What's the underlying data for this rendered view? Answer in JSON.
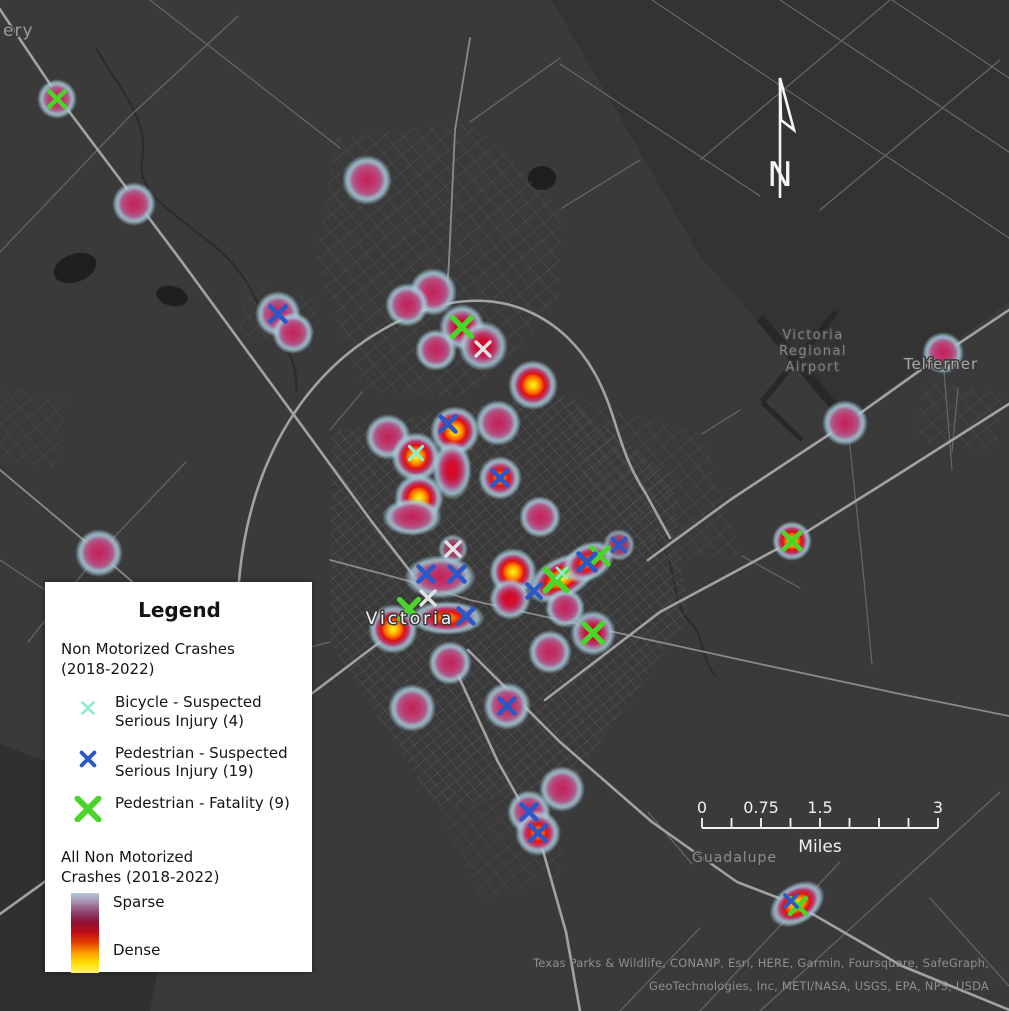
{
  "map": {
    "background_color": "#3a3a3a",
    "road_color": "#a2a2a2",
    "north_arrow_label": "N",
    "place_labels": [
      {
        "text": "ery",
        "x": 3,
        "y": 36,
        "size": 17,
        "color": "#9c9c9c",
        "anchor": "start",
        "spacing": 1
      },
      {
        "text": "Victoria",
        "x": 410,
        "y": 624,
        "size": 17,
        "color": "#f4f4f4",
        "anchor": "middle",
        "spacing": 3
      },
      {
        "text": "Victoria",
        "x": 813,
        "y": 339,
        "size": 13,
        "color": "#858585",
        "anchor": "middle",
        "spacing": 1.5
      },
      {
        "text": "Regional",
        "x": 813,
        "y": 355,
        "size": 13,
        "color": "#858585",
        "anchor": "middle",
        "spacing": 1.5
      },
      {
        "text": "Airport",
        "x": 813,
        "y": 371,
        "size": 13,
        "color": "#858585",
        "anchor": "middle",
        "spacing": 1.5
      },
      {
        "text": "Telferner",
        "x": 941,
        "y": 369,
        "size": 15,
        "color": "#a8a8a8",
        "anchor": "middle",
        "spacing": 1
      },
      {
        "text": "Guadalupe",
        "x": 692,
        "y": 862,
        "size": 14,
        "color": "#8d8d8d",
        "anchor": "start",
        "spacing": 1
      }
    ],
    "attribution_lines": [
      "Texas Parks & Wildlife, CONANP, Esri, HERE, Garmin, Foursquare, SafeGraph,",
      "GeoTechnologies, Inc, METI/NASA, USGS, EPA, NPS, USDA"
    ]
  },
  "scalebar": {
    "x": 702,
    "y": 828,
    "width": 236,
    "total_miles": 3,
    "divisions": 8,
    "unit": "Miles",
    "color": "#f2f2f2",
    "labels": [
      {
        "text": "0",
        "mile": 0
      },
      {
        "text": "0.75",
        "mile": 0.75
      },
      {
        "text": "1.5",
        "mile": 1.5
      },
      {
        "text": "3",
        "mile": 3
      }
    ]
  },
  "legend": {
    "title": "Legend",
    "section1_title": "Non Motorized Crashes\n(2018-2022)",
    "items": [
      {
        "type": "bicycle",
        "label": "Bicycle - Suspected Serious Injury (4)"
      },
      {
        "type": "pedestrian",
        "label": "Pedestrian - Suspected Serious Injury (19)"
      },
      {
        "type": "fatality",
        "label": "Pedestrian - Fatality (9)"
      }
    ],
    "section2_title": "All Non Motorized\nCrashes (2018-2022)",
    "sparse_label": "Sparse",
    "dense_label": "Dense",
    "gradient_colors": [
      "#b2cbd7",
      "#a487a9",
      "#8e3f6b",
      "#8f1030",
      "#c20d18",
      "#e34300",
      "#ff9e00",
      "#ffdf00",
      "#fff06e"
    ]
  },
  "marker_styles": {
    "bicycle": {
      "color": "#8feccf",
      "size": 6.5,
      "width": 3.2
    },
    "pedestrian": {
      "color": "#2b58c8",
      "size": 7.5,
      "width": 4.6
    },
    "fatality": {
      "color": "#4bd42a",
      "size": 10.5,
      "width": 6
    },
    "unknown": {
      "color": "#e3e3e3",
      "size": 7,
      "width": 3.4
    }
  },
  "heat_styles": {
    "pink": [
      [
        0,
        "#c2215a",
        1
      ],
      [
        0.38,
        "#bd3a6f",
        1
      ],
      [
        0.58,
        "#b05d8e",
        0.96
      ],
      [
        0.72,
        "#a9b4c8",
        0.9
      ],
      [
        0.8,
        "#a9cede",
        0.8
      ],
      [
        1,
        "#a9cede",
        0
      ]
    ],
    "red": [
      [
        0,
        "#e00520",
        1
      ],
      [
        0.3,
        "#cc1032",
        1
      ],
      [
        0.52,
        "#bb3f74",
        0.97
      ],
      [
        0.7,
        "#a9a0bd",
        0.9
      ],
      [
        0.79,
        "#a9cede",
        0.8
      ],
      [
        1,
        "#a9cede",
        0
      ]
    ],
    "orange": [
      [
        0,
        "#ffa400",
        1
      ],
      [
        0.2,
        "#ff6400",
        1
      ],
      [
        0.38,
        "#de1414",
        1
      ],
      [
        0.56,
        "#ba3e73",
        0.97
      ],
      [
        0.72,
        "#a9b4c8",
        0.9
      ],
      [
        0.81,
        "#a9cede",
        0.78
      ],
      [
        1,
        "#a9cede",
        0
      ]
    ],
    "yellow": [
      [
        0,
        "#fff133",
        1
      ],
      [
        0.16,
        "#ffc400",
        1
      ],
      [
        0.32,
        "#ff7000",
        1
      ],
      [
        0.47,
        "#dd1111",
        1
      ],
      [
        0.62,
        "#b93a70",
        0.97
      ],
      [
        0.75,
        "#a9b4c8",
        0.9
      ],
      [
        0.83,
        "#a9cede",
        0.75
      ],
      [
        1,
        "#a9cede",
        0
      ]
    ]
  },
  "heat_blobs": [
    {
      "x": 57,
      "y": 99,
      "r": 20,
      "kind": "pink"
    },
    {
      "x": 134,
      "y": 204,
      "r": 22,
      "kind": "pink"
    },
    {
      "x": 367,
      "y": 180,
      "r": 25,
      "kind": "pink"
    },
    {
      "x": 278,
      "y": 314,
      "r": 23,
      "kind": "pink"
    },
    {
      "x": 293,
      "y": 333,
      "r": 21,
      "kind": "pink"
    },
    {
      "x": 433,
      "y": 292,
      "r": 24,
      "kind": "pink"
    },
    {
      "x": 407,
      "y": 305,
      "r": 22,
      "kind": "pink"
    },
    {
      "x": 462,
      "y": 327,
      "r": 23,
      "kind": "red"
    },
    {
      "x": 483,
      "y": 346,
      "r": 25,
      "kind": "red"
    },
    {
      "x": 436,
      "y": 350,
      "r": 21,
      "kind": "pink"
    },
    {
      "x": 533,
      "y": 385,
      "r": 25,
      "kind": "yellow"
    },
    {
      "x": 388,
      "y": 437,
      "r": 23,
      "kind": "pink"
    },
    {
      "x": 498,
      "y": 423,
      "r": 23,
      "kind": "pink"
    },
    {
      "x": 455,
      "y": 431,
      "r": 25,
      "kind": "yellow"
    },
    {
      "x": 416,
      "y": 457,
      "r": 25,
      "kind": "yellow"
    },
    {
      "x": 452,
      "y": 470,
      "rx": 20,
      "ry": 30,
      "kind": "red"
    },
    {
      "x": 500,
      "y": 478,
      "r": 22,
      "kind": "orange"
    },
    {
      "x": 419,
      "y": 498,
      "r": 25,
      "kind": "yellow"
    },
    {
      "x": 412,
      "y": 517,
      "rx": 30,
      "ry": 19,
      "kind": "pink"
    },
    {
      "x": 540,
      "y": 517,
      "r": 21,
      "kind": "pink"
    },
    {
      "x": 99,
      "y": 553,
      "r": 24,
      "kind": "pink"
    },
    {
      "x": 453,
      "y": 549,
      "r": 15,
      "kind": "faint"
    },
    {
      "x": 440,
      "y": 577,
      "rx": 36,
      "ry": 22,
      "kind": "pink"
    },
    {
      "x": 513,
      "y": 572,
      "r": 24,
      "kind": "yellow"
    },
    {
      "x": 510,
      "y": 599,
      "r": 21,
      "kind": "red"
    },
    {
      "x": 562,
      "y": 578,
      "rx": 38,
      "ry": 21,
      "rot": -28,
      "kind": "yellow"
    },
    {
      "x": 588,
      "y": 562,
      "rx": 28,
      "ry": 19,
      "rot": -28,
      "kind": "orange"
    },
    {
      "x": 619,
      "y": 545,
      "r": 16,
      "kind": "faint"
    },
    {
      "x": 447,
      "y": 618,
      "rx": 38,
      "ry": 17,
      "kind": "orange"
    },
    {
      "x": 393,
      "y": 629,
      "r": 25,
      "kind": "yellow"
    },
    {
      "x": 565,
      "y": 608,
      "r": 20,
      "kind": "pink"
    },
    {
      "x": 550,
      "y": 652,
      "r": 22,
      "kind": "pink"
    },
    {
      "x": 593,
      "y": 633,
      "r": 23,
      "kind": "red"
    },
    {
      "x": 450,
      "y": 663,
      "r": 22,
      "kind": "pink"
    },
    {
      "x": 412,
      "y": 708,
      "r": 24,
      "kind": "pink"
    },
    {
      "x": 507,
      "y": 706,
      "r": 24,
      "kind": "pink"
    },
    {
      "x": 562,
      "y": 789,
      "r": 23,
      "kind": "pink"
    },
    {
      "x": 529,
      "y": 812,
      "r": 22,
      "kind": "pink"
    },
    {
      "x": 538,
      "y": 833,
      "r": 23,
      "kind": "orange"
    },
    {
      "x": 845,
      "y": 423,
      "r": 23,
      "kind": "pink"
    },
    {
      "x": 943,
      "y": 353,
      "r": 21,
      "kind": "pink"
    },
    {
      "x": 792,
      "y": 541,
      "r": 20,
      "kind": "yellow"
    },
    {
      "x": 797,
      "y": 904,
      "rx": 30,
      "ry": 20,
      "rot": -32,
      "kind": "yellow"
    }
  ],
  "crash_markers": [
    {
      "x": 57,
      "y": 99,
      "type": "fatality",
      "scale": 0.75
    },
    {
      "x": 462,
      "y": 327,
      "type": "fatality",
      "scale": 0.9
    },
    {
      "x": 409,
      "y": 609,
      "type": "fatality",
      "scale": 0.9
    },
    {
      "x": 556,
      "y": 580,
      "type": "fatality",
      "scale": 1
    },
    {
      "x": 600,
      "y": 556,
      "type": "fatality",
      "scale": 0.8
    },
    {
      "x": 593,
      "y": 633,
      "type": "fatality",
      "scale": 0.9
    },
    {
      "x": 792,
      "y": 541,
      "type": "fatality",
      "scale": 0.8
    },
    {
      "x": 798,
      "y": 906,
      "type": "fatality",
      "scale": 0.75
    },
    {
      "x": 278,
      "y": 314,
      "type": "pedestrian",
      "scale": 1
    },
    {
      "x": 448,
      "y": 424,
      "type": "pedestrian",
      "scale": 1
    },
    {
      "x": 500,
      "y": 478,
      "type": "pedestrian",
      "scale": 1
    },
    {
      "x": 426,
      "y": 574,
      "type": "pedestrian",
      "scale": 1
    },
    {
      "x": 457,
      "y": 574,
      "type": "pedestrian",
      "scale": 1
    },
    {
      "x": 534,
      "y": 591,
      "type": "pedestrian",
      "scale": 0.9
    },
    {
      "x": 466,
      "y": 616,
      "type": "pedestrian",
      "scale": 1
    },
    {
      "x": 587,
      "y": 562,
      "type": "pedestrian",
      "scale": 1.1
    },
    {
      "x": 619,
      "y": 545,
      "type": "pedestrian",
      "scale": 0.85
    },
    {
      "x": 507,
      "y": 706,
      "type": "pedestrian",
      "scale": 1
    },
    {
      "x": 529,
      "y": 812,
      "type": "pedestrian",
      "scale": 1
    },
    {
      "x": 538,
      "y": 833,
      "type": "pedestrian",
      "scale": 1
    },
    {
      "x": 791,
      "y": 901,
      "type": "pedestrian",
      "scale": 0.8
    },
    {
      "x": 416,
      "y": 453,
      "type": "bicycle",
      "scale": 1
    },
    {
      "x": 562,
      "y": 573,
      "type": "bicycle",
      "scale": 0.8
    },
    {
      "x": 483,
      "y": 349,
      "type": "unknown",
      "scale": 1
    },
    {
      "x": 453,
      "y": 549,
      "type": "unknown",
      "scale": 1
    },
    {
      "x": 428,
      "y": 598,
      "type": "unknown",
      "scale": 1
    }
  ]
}
